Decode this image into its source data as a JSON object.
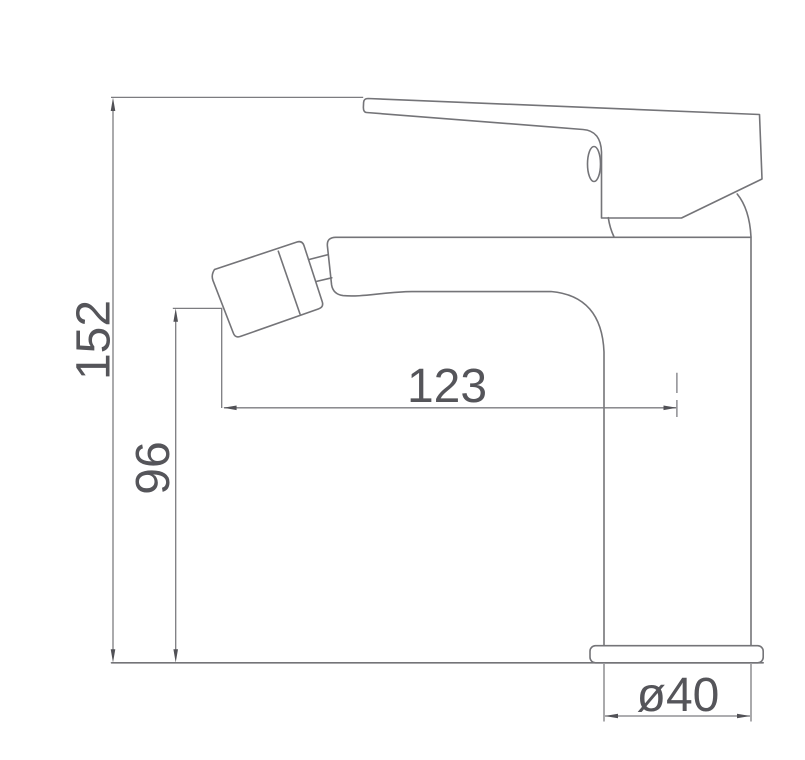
{
  "drawing": {
    "dimensions": {
      "total_height": "152",
      "spout_height": "96",
      "spout_reach": "123",
      "base_diameter": "ø40"
    },
    "colors": {
      "background": "#ffffff",
      "outline": "#747478",
      "dimension_line": "#7c7c80",
      "arrowhead": "#515156",
      "text": "#55555a"
    }
  }
}
